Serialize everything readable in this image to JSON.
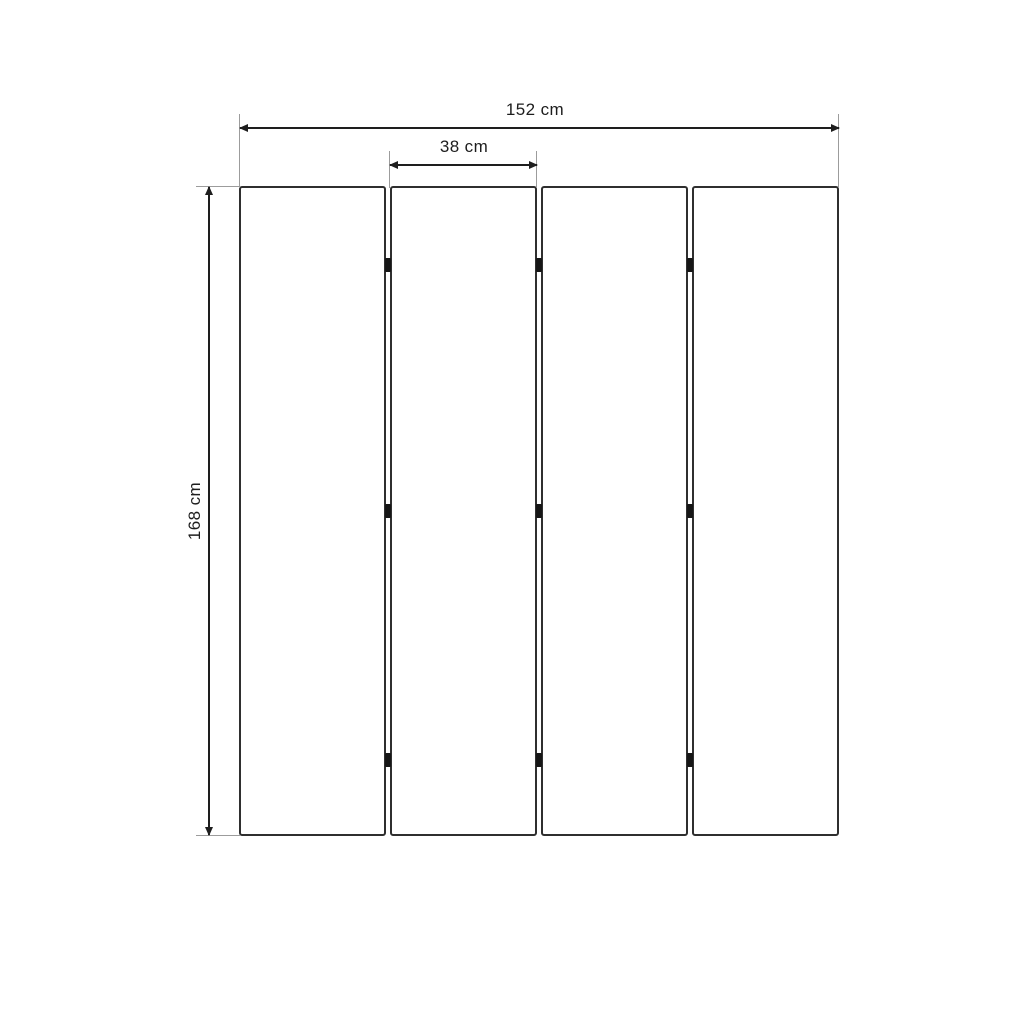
{
  "diagram": {
    "type": "dimension-drawing",
    "panel_count": 4,
    "hinge_joint_count": 3,
    "hinge_marks_per_joint": 3,
    "dimensions": {
      "total_width": {
        "label": "152 cm",
        "value": 152,
        "unit": "cm"
      },
      "panel_width": {
        "label": "38 cm",
        "value": 38,
        "unit": "cm"
      },
      "height": {
        "label": "168 cm",
        "value": 168,
        "unit": "cm"
      }
    },
    "colors": {
      "background": "#ffffff",
      "dimension_line": "#1e1e1e",
      "extension_line": "#9c9c9c",
      "panel_border": "#2f2f2f",
      "panel_fill": "#ffffff",
      "hinge": "#161616",
      "text": "#1d1d1d"
    }
  }
}
